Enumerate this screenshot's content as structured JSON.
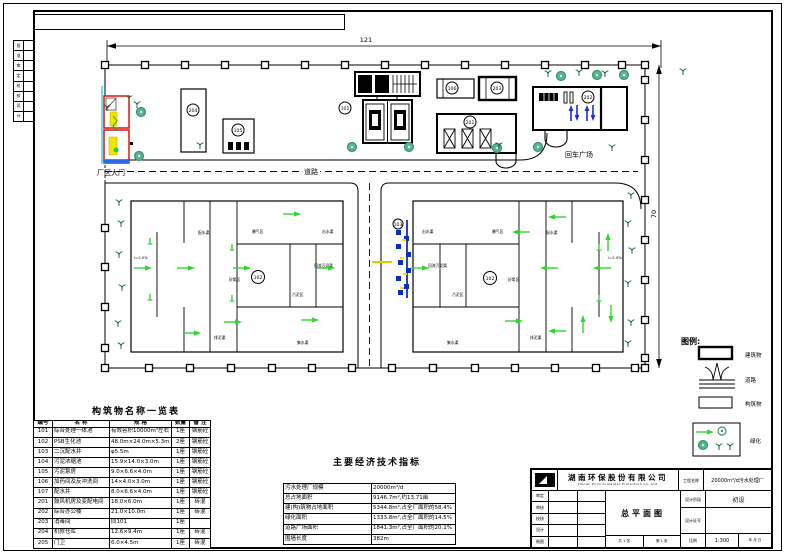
{
  "frame": {
    "strip_rows": [
      "批",
      "准",
      "审",
      "定",
      "校",
      "核",
      "设",
      "计"
    ]
  },
  "dimensions": {
    "width": "121",
    "height": "70"
  },
  "site": {
    "gate": "厂区大门",
    "road": "道路",
    "plaza": "回车广场"
  },
  "circled": [
    "204",
    "105",
    "101",
    "106",
    "203",
    "201",
    "202",
    "102",
    "102",
    "103"
  ],
  "pond_labels_left": [
    "配水渠",
    "曝气区",
    "出水渠",
    "i=2.0%",
    "好氧区",
    "回流污泥渠",
    "污泥区",
    "排泥渠",
    "集水渠"
  ],
  "pond_labels_right": [
    "配水渠",
    "曝气区",
    "出水渠",
    "i=2.0%",
    "好氧区",
    "回流污泥渠",
    "污泥区",
    "排泥渠",
    "集水渠"
  ],
  "legend": {
    "title": "图例:",
    "items": [
      "建筑物",
      "道路",
      "构筑物",
      "绿化"
    ]
  },
  "structures_table": {
    "title": "构筑物名称一览表",
    "headers": [
      "编号",
      "名  称",
      "规  格",
      "数量",
      "备 注"
    ],
    "rows": [
      [
        "101",
        "综合处理一体池",
        "有效容积10000m³左右",
        "1座",
        "钢筋砼"
      ],
      [
        "102",
        "PSB生化池",
        "48.0m×24.0m×5.3m",
        "2座",
        "钢筋砼"
      ],
      [
        "103",
        "二沉配水井",
        "φ5.5m",
        "1座",
        "钢筋砼"
      ],
      [
        "104",
        "污泥浓缩池",
        "15.9×14.0×3.0m",
        "1座",
        "钢筋砼"
      ],
      [
        "105",
        "污泥泵房",
        "9.0×6.6×4.0m",
        "1座",
        "钢筋砼"
      ],
      [
        "106",
        "加药间及反冲洗间",
        "14×4.0×3.0m",
        "1座",
        "钢筋砼"
      ],
      [
        "107",
        "配水井",
        "8.0×6.6×4.0m",
        "1座",
        "钢筋砼"
      ],
      [
        "201",
        "鼓风机房及变配电间",
        "18.0×6.0m",
        "1座",
        "砖混"
      ],
      [
        "202",
        "综合办公楼",
        "21.0×10.0m",
        "1座",
        "砖混"
      ],
      [
        "203",
        "消毒间",
        "同101",
        "1座",
        ""
      ],
      [
        "204",
        "机修仓库",
        "12.6×9.4m",
        "1座",
        "砖混"
      ],
      [
        "205",
        "门卫",
        "6.0×4.5m",
        "1座",
        "砖混"
      ]
    ]
  },
  "indicators_table": {
    "title": "主要经济技术指标",
    "rows": [
      [
        "污水处理厂规模",
        "20000m³/d"
      ],
      [
        "总占地面积",
        "9146.7m²,约13.71亩"
      ],
      [
        "建(构)筑物占地面积",
        "5344.8m²,占全厂面积的58.4%"
      ],
      [
        "绿化面积",
        "1333.8m²,占全厂面积的14.5%"
      ],
      [
        "道路广场面积",
        "1841.3m²,占全厂面积的20.1%"
      ],
      [
        "围墙长度",
        "382m"
      ]
    ]
  },
  "title_block": {
    "company_cn": "湖南环保股份有限公司",
    "company_en": "Hunan Environmental Protection Co.,Ltd",
    "sign_labels": [
      "审定",
      "审核",
      "校核",
      "设计",
      "制图"
    ],
    "date_line": "年    月    日",
    "total_sheet": "共 1 张",
    "sheet_no": "第 1 张",
    "drawing_name": "总平面图",
    "project_label": "工程名称",
    "project_value": "20000m³/d污水处理厂",
    "stage_label": "设计阶段",
    "stage_value": "初设",
    "blank_label": "设计证号",
    "scale_label": "比例",
    "scale_value": "1:300"
  }
}
